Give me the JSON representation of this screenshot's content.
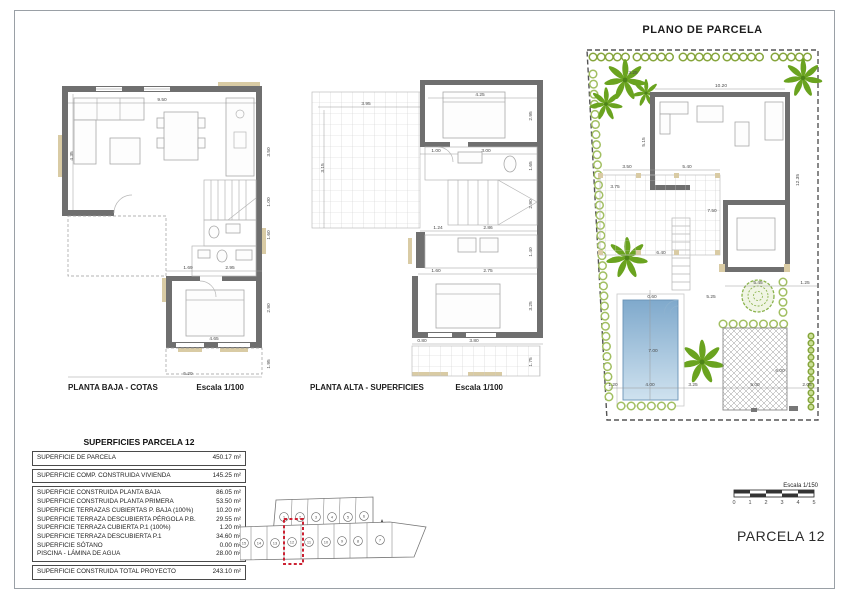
{
  "plans": {
    "baja": {
      "caption": "PLANTA BAJA - COTAS",
      "scale": "Escala 1/100",
      "dims": {
        "width_top": "9.50",
        "height_left": "4.35",
        "kitchen_right": "3.50",
        "stair_right": "1.00",
        "bath_right": "1.60",
        "bed_top_a": "1.69",
        "bed_top_b": "2.95",
        "bed_right": "2.90",
        "bed_width": "4.65",
        "porch_right": "1.95",
        "width_bottom": "5.20"
      }
    },
    "alta": {
      "caption": "PLANTA ALTA - SUPERFICIES",
      "scale": "Escala 1/100",
      "dims": {
        "terrace_w": "3.95",
        "terrace_h": "3.15",
        "bed_top": "4.25",
        "bed_right": "2.95",
        "hall_a": "1.00",
        "hall_b": "3.00",
        "bath_right": "1.65",
        "stair_right": "2.90",
        "land_a": "1.24",
        "land_b": "2.86",
        "room_a": "1.60",
        "room_b": "2.75",
        "util_right": "1.40",
        "bed2_right": "3.25",
        "bot_a": "0.80",
        "bot_b": "3.80",
        "terr2_right": "1.75"
      }
    },
    "parcela": {
      "title": "PLANO DE PARCELA",
      "dims": {
        "hedge": "3.25",
        "house_w": "10.20",
        "house_h": "5.15",
        "side_right": "12.35",
        "perg_a": "3.50",
        "perg_b": "5.40",
        "perg_c": "3.75",
        "patio": "7.50",
        "wing_w": "5.45",
        "wing_r": "1.25",
        "stair_len": "6.40",
        "court": "5.25",
        "pool_gap": "0.60",
        "pool_l": "7.00",
        "pool_w": "4.00",
        "strip_a": "1.20",
        "strip_b": "3.25",
        "strip_c": "5.00",
        "strip_d": "2.05",
        "terr_right": "6.00"
      }
    }
  },
  "table": {
    "title": "SUPERFICIES PARCELA 12",
    "rows": [
      {
        "label": "SUPERFICIE DE PARCELA",
        "value": "450.17 m²"
      },
      {
        "label": "SUPERFICIE COMP. CONSTRUIDA VIVIENDA",
        "value": "145.25 m²"
      },
      {
        "label": "SUPERFICIE CONSTRUIDA PLANTA BAJA",
        "value": "86.05 m²"
      },
      {
        "label": "SUPERFICIE CONSTRUIDA PLANTA PRIMERA",
        "value": "53.50 m²"
      },
      {
        "label": "SUPERFICIE TERRAZAS CUBIERTAS P. BAJA (100%)",
        "value": "10.20 m²"
      },
      {
        "label": "SUPERFICIE TERRAZA DESCUBIERTA PÉRGOLA P.B.",
        "value": "29.55 m²"
      },
      {
        "label": "SUPERFICIE TERRAZA CUBIERTA P.1 (100%)",
        "value": "1.20 m²"
      },
      {
        "label": "SUPERFICIE TERRAZA DESCUBIERTA P.1",
        "value": "34.60 m²"
      },
      {
        "label": "SUPERFICIE SÓTANO",
        "value": "0.00 m²"
      },
      {
        "label": "PISCINA - LÁMINA DE AGUA",
        "value": "28.00 m²"
      },
      {
        "label": "SUPERFICIE CONSTRUIDA TOTAL PROYECTO",
        "value": "243.10 m²"
      }
    ]
  },
  "location": {
    "top": [
      "1",
      "2",
      "3",
      "4",
      "5",
      "6"
    ],
    "bottom": [
      "15",
      "14",
      "13",
      "12",
      "11",
      "10",
      "9",
      "8",
      "7"
    ],
    "highlighted": "12"
  },
  "footer": {
    "scale_label": "Escala 1/150",
    "ticks": [
      "0",
      "1",
      "2",
      "3",
      "4",
      "5"
    ],
    "parcel": "PARCELA 12"
  },
  "colors": {
    "wall": "#6f6f6f",
    "beige": "#d9cba4",
    "pool_top": "#7fa9cc",
    "pool_bottom": "#cfe2ef",
    "palm_green": "#6aa31f",
    "bush_green": "#a2bf62",
    "highlight_red": "#cc2233"
  }
}
